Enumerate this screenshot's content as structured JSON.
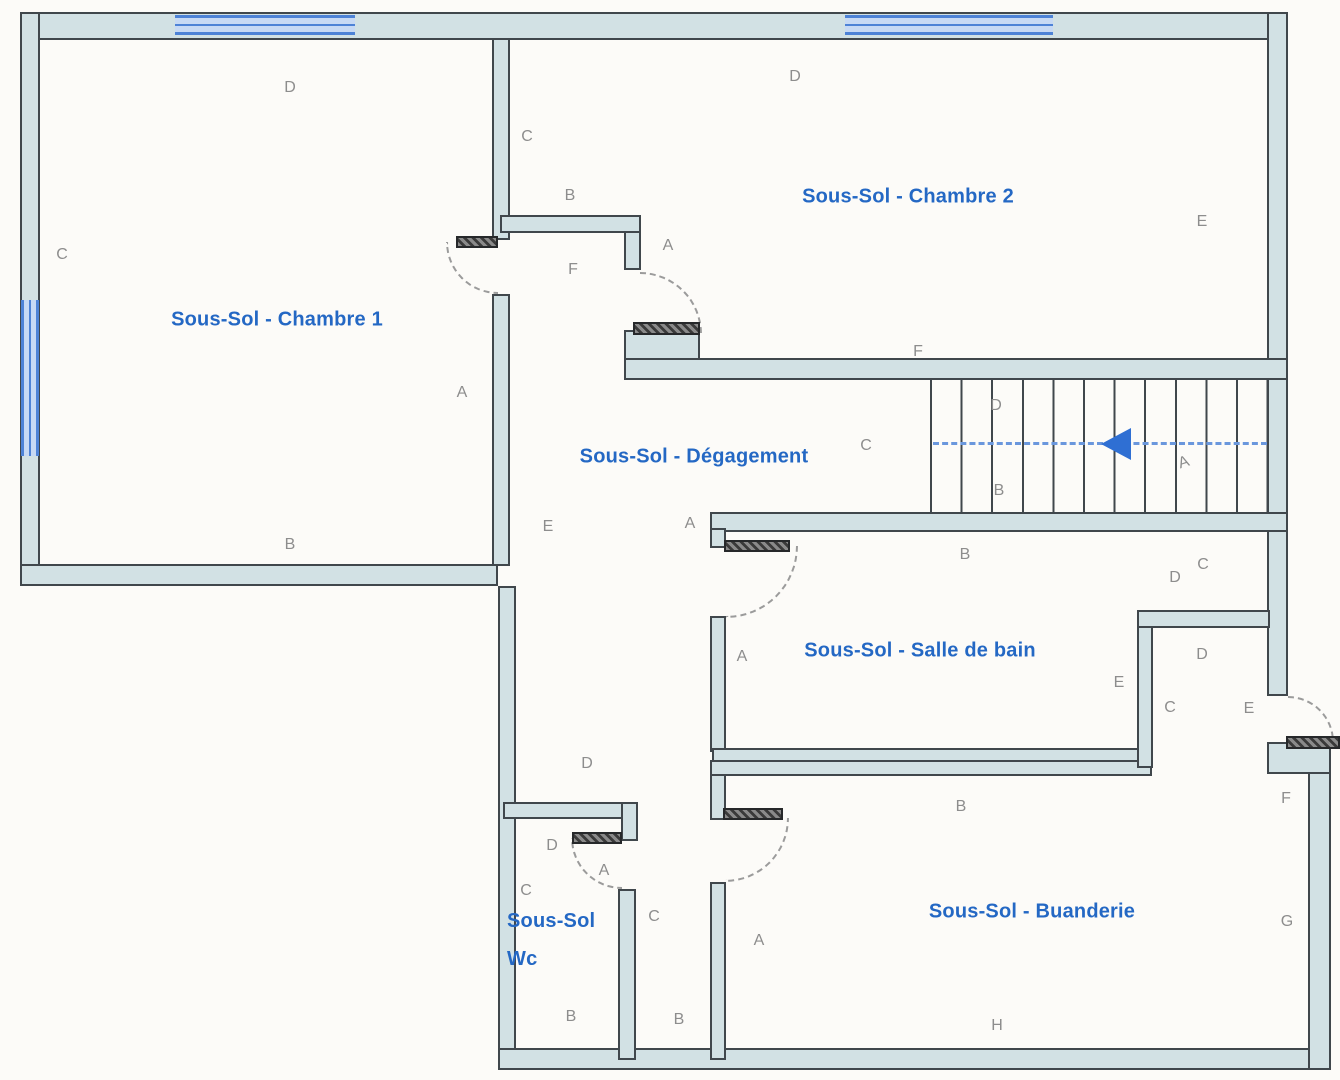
{
  "plan_title": "Sous-Sol",
  "colors": {
    "wall_fill": "#d2e1e4",
    "wall_line": "#40474c",
    "window_fill": "#c7d9f4",
    "window_line": "#4d82d6",
    "label_blue": "#2468c4",
    "letter_gray": "#8d8d8d",
    "arrow_blue": "#2f6fd3",
    "walkline_blue": "#6a97dd",
    "background": "#fcfbf8"
  },
  "rooms": [
    {
      "id": "chambre1",
      "label": "Sous-Sol - Chambre 1",
      "x": 277,
      "y": 320
    },
    {
      "id": "chambre2",
      "label": "Sous-Sol - Chambre 2",
      "x": 908,
      "y": 197
    },
    {
      "id": "degagement",
      "label": "Sous-Sol - Dégagement",
      "x": 694,
      "y": 457
    },
    {
      "id": "salle-de-bain",
      "label": "Sous-Sol - Salle de bain",
      "x": 920,
      "y": 651
    },
    {
      "id": "buanderie",
      "label": "Sous-Sol - Buanderie",
      "x": 1032,
      "y": 912
    },
    {
      "id": "wc",
      "label": "Sous-Sol Wc",
      "lines": [
        "Sous-Sol",
        "Wc"
      ],
      "x": 507,
      "y": 940,
      "align": "left"
    }
  ],
  "wall_letters": [
    {
      "c": "D",
      "x": 290,
      "y": 88
    },
    {
      "c": "C",
      "x": 62,
      "y": 255
    },
    {
      "c": "A",
      "x": 462,
      "y": 393
    },
    {
      "c": "B",
      "x": 290,
      "y": 545
    },
    {
      "c": "C",
      "x": 527,
      "y": 137
    },
    {
      "c": "B",
      "x": 570,
      "y": 196
    },
    {
      "c": "F",
      "x": 573,
      "y": 270
    },
    {
      "c": "A",
      "x": 668,
      "y": 246
    },
    {
      "c": "D",
      "x": 795,
      "y": 77
    },
    {
      "c": "E",
      "x": 1202,
      "y": 222
    },
    {
      "c": "F",
      "x": 918,
      "y": 352
    },
    {
      "c": "C",
      "x": 866,
      "y": 446
    },
    {
      "c": "D",
      "x": 996,
      "y": 406
    },
    {
      "c": "B",
      "x": 999,
      "y": 491
    },
    {
      "c": "A",
      "x": 1184,
      "y": 463,
      "rot": -18
    },
    {
      "c": "E",
      "x": 548,
      "y": 527
    },
    {
      "c": "A",
      "x": 690,
      "y": 524
    },
    {
      "c": "A",
      "x": 742,
      "y": 657
    },
    {
      "c": "B",
      "x": 965,
      "y": 555
    },
    {
      "c": "D",
      "x": 1175,
      "y": 578
    },
    {
      "c": "C",
      "x": 1203,
      "y": 565
    },
    {
      "c": "D",
      "x": 1202,
      "y": 655
    },
    {
      "c": "E",
      "x": 1119,
      "y": 683
    },
    {
      "c": "C",
      "x": 1170,
      "y": 708
    },
    {
      "c": "E",
      "x": 1249,
      "y": 709
    },
    {
      "c": "F",
      "x": 1286,
      "y": 799
    },
    {
      "c": "B",
      "x": 961,
      "y": 807
    },
    {
      "c": "G",
      "x": 1287,
      "y": 922
    },
    {
      "c": "H",
      "x": 997,
      "y": 1026
    },
    {
      "c": "D",
      "x": 587,
      "y": 764
    },
    {
      "c": "D",
      "x": 552,
      "y": 846
    },
    {
      "c": "A",
      "x": 604,
      "y": 871
    },
    {
      "c": "C",
      "x": 526,
      "y": 891
    },
    {
      "c": "B",
      "x": 571,
      "y": 1017
    },
    {
      "c": "C",
      "x": 654,
      "y": 917
    },
    {
      "c": "B",
      "x": 679,
      "y": 1020
    },
    {
      "c": "A",
      "x": 759,
      "y": 941
    }
  ],
  "stairs": {
    "steps": 11,
    "walkline": "dashed",
    "arrow_direction": "left"
  }
}
